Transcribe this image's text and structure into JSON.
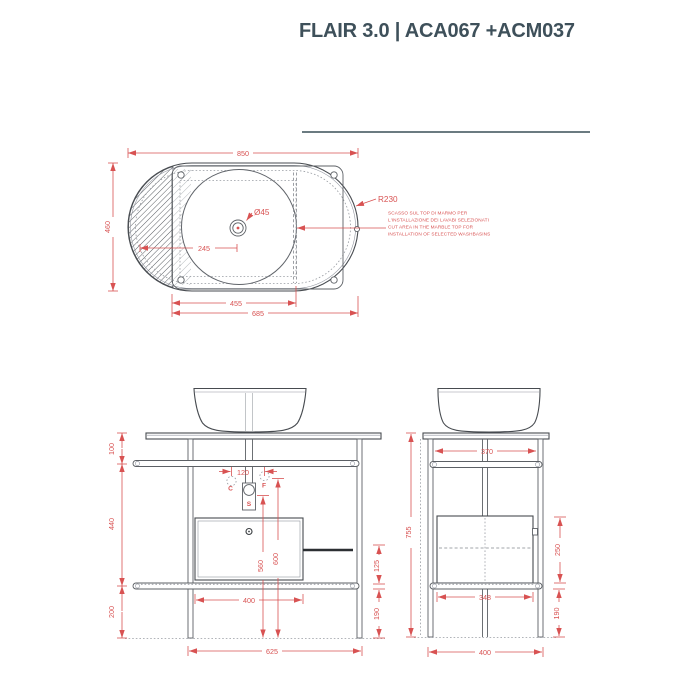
{
  "title": "FLAIR 3.0 | ACA067 +ACM037",
  "colors": {
    "accent_red": "#d85252",
    "line_dark": "#474b50",
    "title_color": "#3e505a",
    "divider": "#6b7b81"
  },
  "top_view": {
    "dim_width": "850",
    "dim_depth": "460",
    "radius_label": "R230",
    "hole_label": "Ø45",
    "dim_tap_offset": "245",
    "dim_cutout_width": "455",
    "dim_frame_width": "685",
    "note_lines": [
      "SCASSO SUL TOP DI MARMO PER",
      "L'INSTALLAZIONE DEI LAVABI SELEZIONATI",
      "CUT AREA IN THE MARBLE TOP FOR",
      "INSTALLATION OF SELECTED WASHBASINS"
    ]
  },
  "front_view": {
    "dim_top_to_bar": "100",
    "dim_bar_to_shelf": "440",
    "dim_shelf_to_floor": "200",
    "dim_cf_spacing": "120",
    "label_cold": "C",
    "label_hot": "F",
    "label_drain": "S",
    "dim_drain_height": "560",
    "dim_supply_height": "600",
    "dim_drawer_width": "400",
    "dim_legs_width": "625",
    "dim_shelf_gap": "125",
    "dim_bar_to_floor": "190"
  },
  "side_view": {
    "dim_total_height": "755",
    "dim_inner_width": "370",
    "dim_cabinet_height": "250",
    "dim_shelf_width": "348",
    "dim_bar_to_floor": "190",
    "dim_legs_depth": "400"
  }
}
